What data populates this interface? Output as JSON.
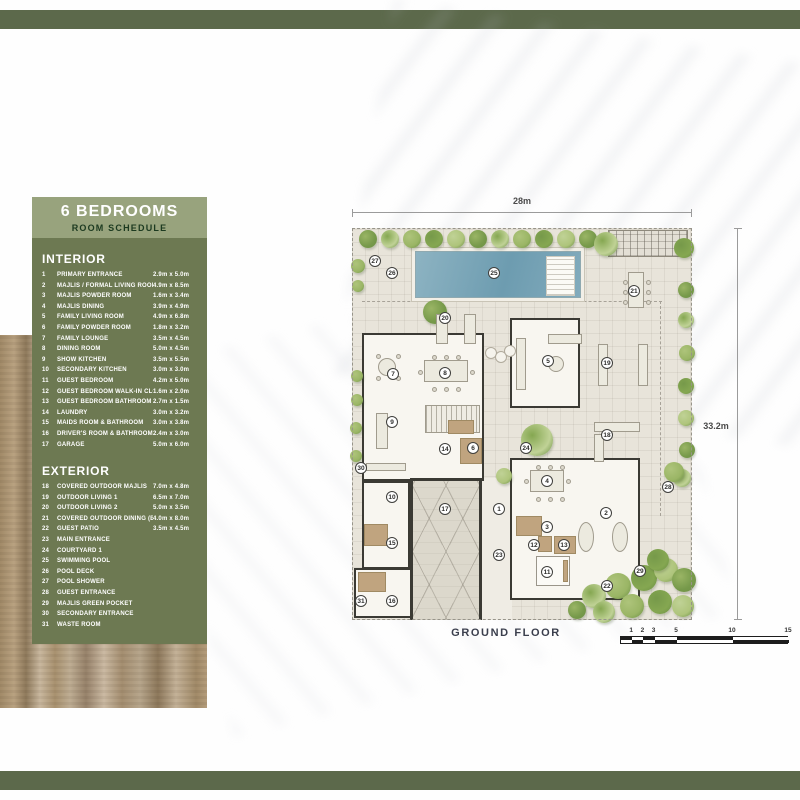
{
  "sidebar": {
    "title": "6 BEDROOMS",
    "subtitle": "ROOM SCHEDULE",
    "sections": [
      {
        "heading": "INTERIOR",
        "rows": [
          {
            "num": "1",
            "label": "PRIMARY ENTRANCE",
            "dim": "2.9m x 5.0m"
          },
          {
            "num": "2",
            "label": "MAJLIS / FORMAL LIVING ROOM",
            "dim": "4.9m x 8.5m"
          },
          {
            "num": "3",
            "label": "MAJLIS POWDER ROOM",
            "dim": "1.6m x 3.4m"
          },
          {
            "num": "4",
            "label": "MAJLIS DINING",
            "dim": "3.9m x 4.9m"
          },
          {
            "num": "5",
            "label": "FAMILY LIVING ROOM",
            "dim": "4.9m x 6.8m"
          },
          {
            "num": "6",
            "label": "FAMILY POWDER ROOM",
            "dim": "1.8m x 3.2m"
          },
          {
            "num": "7",
            "label": "FAMILY LOUNGE",
            "dim": "3.5m x 4.5m"
          },
          {
            "num": "8",
            "label": "DINING ROOM",
            "dim": "5.0m x 4.5m"
          },
          {
            "num": "9",
            "label": "SHOW KITCHEN",
            "dim": "3.5m x 5.5m"
          },
          {
            "num": "10",
            "label": "SECONDARY KITCHEN",
            "dim": "3.0m x 3.0m"
          },
          {
            "num": "11",
            "label": "GUEST BEDROOM",
            "dim": "4.2m x 5.0m"
          },
          {
            "num": "12",
            "label": "GUEST BEDROOM WALK-IN CLOSET",
            "dim": "1.6m x 2.0m"
          },
          {
            "num": "13",
            "label": "GUEST BEDROOM BATHROOM",
            "dim": "2.7m x 1.5m"
          },
          {
            "num": "14",
            "label": "LAUNDRY",
            "dim": "3.0m x 3.2m"
          },
          {
            "num": "15",
            "label": "MAIDS ROOM & BATHROOM",
            "dim": "3.0m x 3.8m"
          },
          {
            "num": "16",
            "label": "DRIVER'S ROOM & BATHROOM",
            "dim": "2.4m x 3.0m"
          },
          {
            "num": "17",
            "label": "GARAGE",
            "dim": "5.0m x 6.0m"
          }
        ]
      },
      {
        "heading": "EXTERIOR",
        "rows": [
          {
            "num": "18",
            "label": "COVERED OUTDOOR MAJLIS",
            "dim": "7.0m x 4.8m"
          },
          {
            "num": "19",
            "label": "OUTDOOR LIVING 1",
            "dim": "6.5m x 7.0m"
          },
          {
            "num": "20",
            "label": "OUTDOOR LIVING 2",
            "dim": "5.0m x 3.5m"
          },
          {
            "num": "21",
            "label": "COVERED OUTDOOR DINING (BBQ)",
            "dim": "4.0m x 8.0m"
          },
          {
            "num": "22",
            "label": "GUEST PATIO",
            "dim": "3.5m x 4.5m"
          },
          {
            "num": "23",
            "label": "MAIN ENTRANCE",
            "dim": ""
          },
          {
            "num": "24",
            "label": "COURTYARD 1",
            "dim": ""
          },
          {
            "num": "25",
            "label": "SWIMMING POOL",
            "dim": ""
          },
          {
            "num": "26",
            "label": "POOL DECK",
            "dim": ""
          },
          {
            "num": "27",
            "label": "POOL SHOWER",
            "dim": ""
          },
          {
            "num": "28",
            "label": "GUEST ENTRANCE",
            "dim": ""
          },
          {
            "num": "29",
            "label": "MAJLIS GREEN POCKET",
            "dim": ""
          },
          {
            "num": "30",
            "label": "SECONDARY ENTRANCE",
            "dim": ""
          },
          {
            "num": "31",
            "label": "WASTE ROOM",
            "dim": ""
          }
        ]
      }
    ]
  },
  "plan": {
    "top_dim": "28m",
    "side_dim": "33.2m",
    "floor_label": "GROUND FLOOR",
    "scale": {
      "ticks": [
        1,
        2,
        3,
        5,
        10,
        15
      ],
      "max": 15
    },
    "markers": [
      {
        "n": "1",
        "x": 147,
        "y": 281
      },
      {
        "n": "2",
        "x": 254,
        "y": 285
      },
      {
        "n": "3",
        "x": 195,
        "y": 299
      },
      {
        "n": "4",
        "x": 195,
        "y": 253
      },
      {
        "n": "5",
        "x": 196,
        "y": 133
      },
      {
        "n": "6",
        "x": 121,
        "y": 220
      },
      {
        "n": "7",
        "x": 41,
        "y": 146
      },
      {
        "n": "8",
        "x": 93,
        "y": 145
      },
      {
        "n": "9",
        "x": 40,
        "y": 194
      },
      {
        "n": "10",
        "x": 40,
        "y": 269
      },
      {
        "n": "11",
        "x": 195,
        "y": 344
      },
      {
        "n": "12",
        "x": 182,
        "y": 317
      },
      {
        "n": "13",
        "x": 212,
        "y": 317
      },
      {
        "n": "14",
        "x": 93,
        "y": 221
      },
      {
        "n": "15",
        "x": 40,
        "y": 315
      },
      {
        "n": "16",
        "x": 40,
        "y": 373
      },
      {
        "n": "17",
        "x": 93,
        "y": 281
      },
      {
        "n": "18",
        "x": 255,
        "y": 207
      },
      {
        "n": "19",
        "x": 255,
        "y": 135
      },
      {
        "n": "20",
        "x": 93,
        "y": 90
      },
      {
        "n": "21",
        "x": 282,
        "y": 63
      },
      {
        "n": "22",
        "x": 255,
        "y": 358
      },
      {
        "n": "23",
        "x": 147,
        "y": 327
      },
      {
        "n": "24",
        "x": 174,
        "y": 220
      },
      {
        "n": "25",
        "x": 142,
        "y": 45
      },
      {
        "n": "26",
        "x": 40,
        "y": 45
      },
      {
        "n": "27",
        "x": 23,
        "y": 33
      },
      {
        "n": "28",
        "x": 316,
        "y": 259
      },
      {
        "n": "29",
        "x": 288,
        "y": 343
      },
      {
        "n": "30",
        "x": 9,
        "y": 240
      },
      {
        "n": "31",
        "x": 9,
        "y": 373
      }
    ]
  },
  "colors": {
    "bar_green": "#5c694b",
    "panel_green": "#6d7952",
    "panel_header_green": "#98a37d",
    "subtitle_text": "#1c3a20",
    "pool_blue": "#7ba6b8",
    "tree_green": "#8fae56",
    "floor_label_text": "#3b3f4d"
  }
}
